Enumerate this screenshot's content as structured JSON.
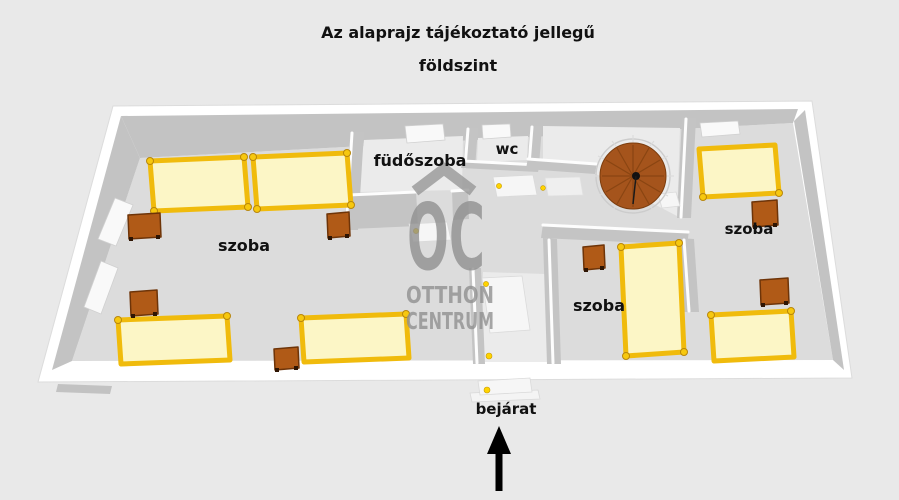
{
  "title": {
    "line1": "Az alaprajz tájékoztató jellegű",
    "line2": "földszint"
  },
  "rooms": {
    "living_room": "szoba",
    "bathroom": "füdőszoba",
    "toilet": "wc",
    "bedroom_top_right": "szoba",
    "bedroom_middle": "szoba"
  },
  "entrance": {
    "label": "bejárat"
  },
  "watermark": {
    "logo": "OC",
    "name_line1": "OTTHON",
    "name_line2": "CENTRUM"
  },
  "colors": {
    "background": "#e9e9e9",
    "floor": "#dcdcdc",
    "wall_side": "#c3c3c3",
    "outer_wall": "#ffffff",
    "bed_fill": "#fcf6c6",
    "bed_frame": "#f0bb0c",
    "nightstand": "#b05a17",
    "staircase": "#a5541c",
    "door_handle": "#ffd400",
    "watermark": "#8f8f8f",
    "label_text": "#111111",
    "arrow": "#000000"
  }
}
